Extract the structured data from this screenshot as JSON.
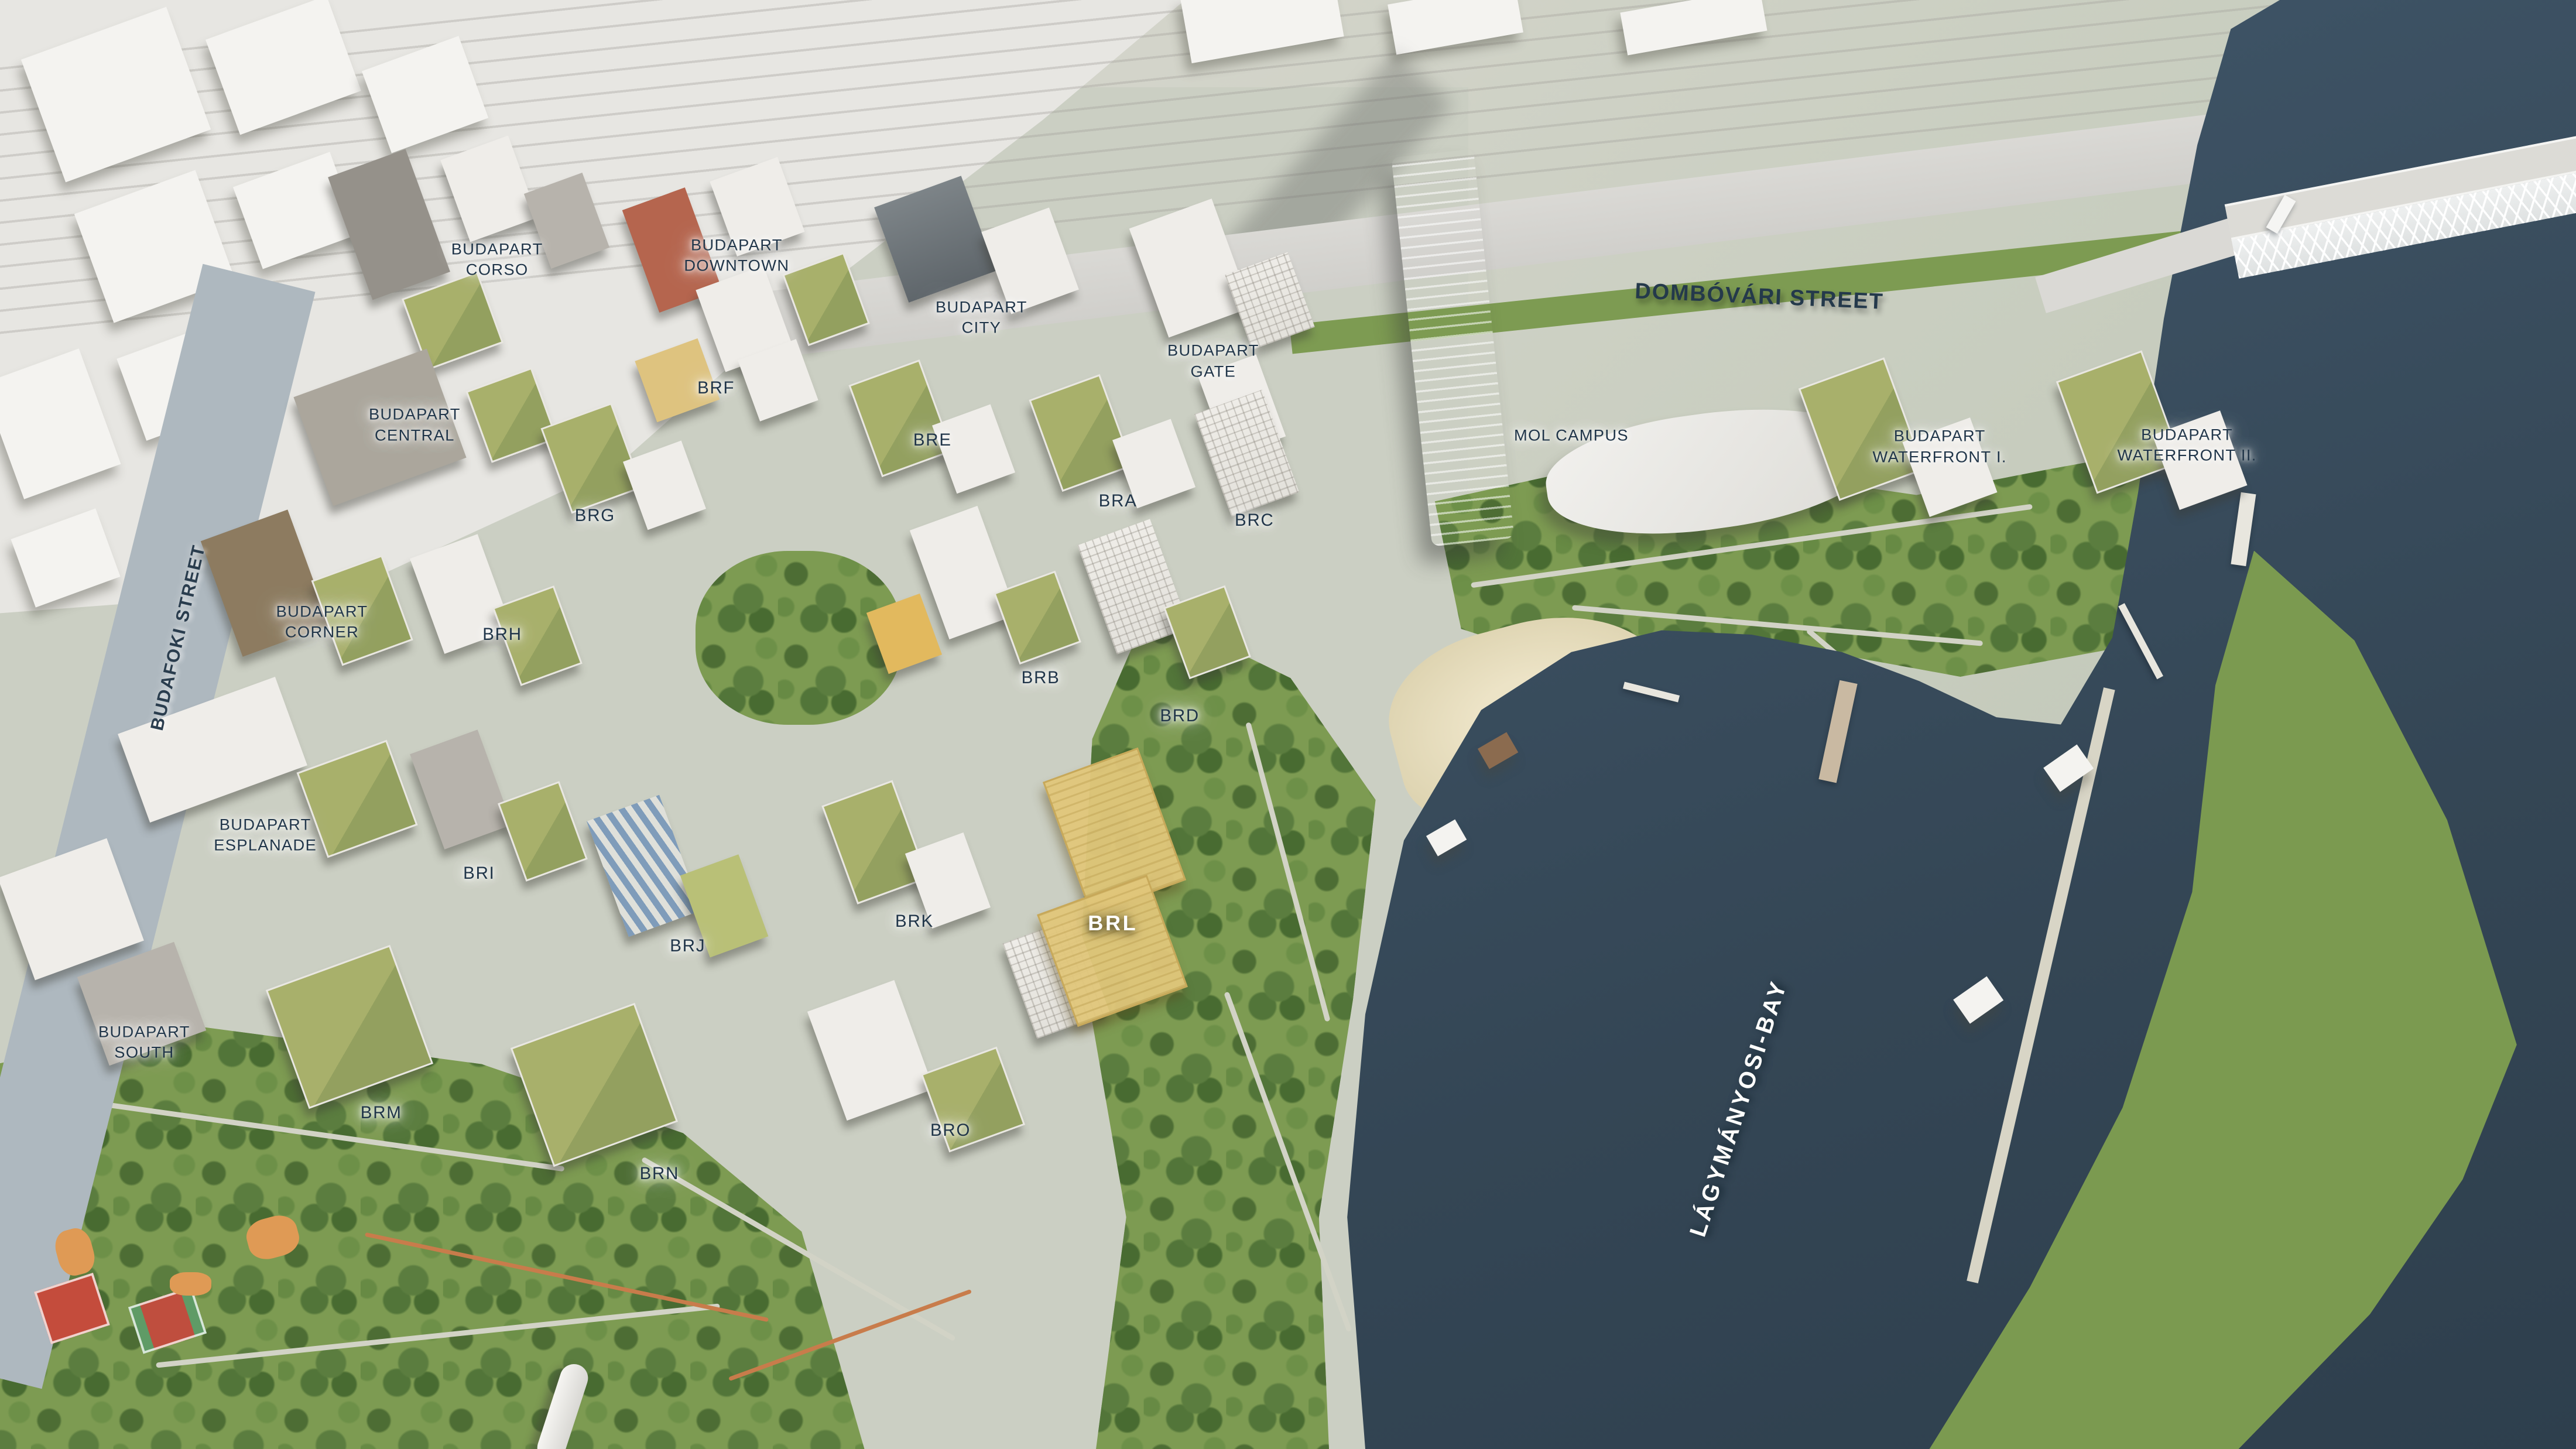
{
  "districts": {
    "corso": {
      "l1": "BUDAPART",
      "l2": "CORSO"
    },
    "downtown": {
      "l1": "BUDAPART",
      "l2": "DOWNTOWN"
    },
    "city": {
      "l1": "BUDAPART",
      "l2": "CITY"
    },
    "gate": {
      "l1": "BUDAPART",
      "l2": "GATE"
    },
    "central": {
      "l1": "BUDAPART",
      "l2": "CENTRAL"
    },
    "corner": {
      "l1": "BUDAPART",
      "l2": "CORNER"
    },
    "esplanade": {
      "l1": "BUDAPART",
      "l2": "ESPLANADE"
    },
    "south": {
      "l1": "BUDAPART",
      "l2": "SOUTH"
    },
    "mol": {
      "l1": "MOL CAMPUS",
      "l2": ""
    },
    "waterfront1": {
      "l1": "BUDAPART",
      "l2": "WATERFRONT I."
    },
    "waterfront2": {
      "l1": "BUDAPART",
      "l2": "WATERFRONT II."
    }
  },
  "building_codes": {
    "brf": "BRF",
    "bre": "BRE",
    "brg": "BRG",
    "bra": "BRA",
    "brc": "BRC",
    "brh": "BRH",
    "brb": "BRB",
    "brd": "BRD",
    "bri": "BRI",
    "brj": "BRJ",
    "brk": "BRK",
    "brl": "BRL",
    "brm": "BRM",
    "brn": "BRN",
    "bro": "BRO"
  },
  "streets": {
    "budafoki": "BUDAFOKI STREET",
    "dombovari": "DOMBÓVÁRI STREET"
  },
  "water_labels": {
    "bay": "LÁGYMÁNYOSI-BAY"
  },
  "highlight": {
    "code": "BRL",
    "building_color": "#e0c67a",
    "label_color": "#ffffff"
  },
  "colors": {
    "water": "#3d5264",
    "park_green": "#7d9b52",
    "tree_green": "#55763a",
    "ground_gray": "#cbcfc3",
    "context_white": "#f3f2ef",
    "label_navy": "#203549",
    "court_red": "#c44c3c",
    "playground_orange": "#df9a55"
  }
}
